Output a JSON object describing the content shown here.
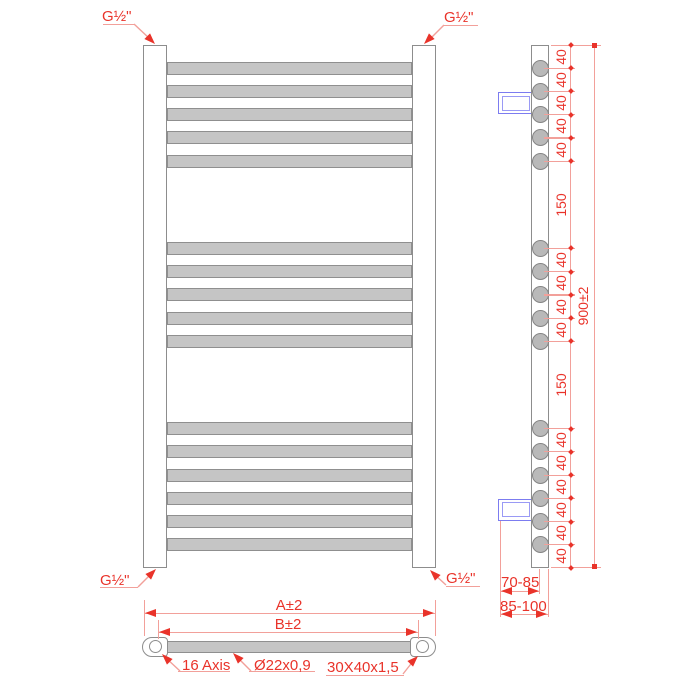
{
  "connection_labels": {
    "top_left": "G½\"",
    "top_right": "G½\"",
    "bottom_left": "G½\"",
    "bottom_right": "G½\""
  },
  "side_view": {
    "overall_height_label": "900±2",
    "wall_bracket_depth_label": "70-85",
    "wall_overall_depth_label": "85-100",
    "tube_groups": [
      5,
      5,
      6
    ],
    "bracket_after_circle": [
      2,
      14
    ],
    "dim_chain": [
      {
        "mm": 40,
        "label": "40"
      },
      {
        "mm": 40,
        "label": "40"
      },
      {
        "mm": 40,
        "label": "40"
      },
      {
        "mm": 40,
        "label": "40"
      },
      {
        "mm": 40,
        "label": "40"
      },
      {
        "mm": 150,
        "label": "150"
      },
      {
        "mm": 40,
        "label": "40"
      },
      {
        "mm": 40,
        "label": "40"
      },
      {
        "mm": 40,
        "label": "40"
      },
      {
        "mm": 40,
        "label": "40"
      },
      {
        "mm": 150,
        "label": "150"
      },
      {
        "mm": 40,
        "label": "40"
      },
      {
        "mm": 40,
        "label": "40"
      },
      {
        "mm": 40,
        "label": "40"
      },
      {
        "mm": 40,
        "label": "40"
      },
      {
        "mm": 40,
        "label": "40"
      },
      {
        "mm": 40,
        "label": "40"
      }
    ],
    "total_mm": 900
  },
  "plan_view": {
    "overall_width_label": "A±2",
    "axis_width_label": "B±2",
    "callout_axis_count": "16 Axis",
    "callout_tube_size": "Ø22x0,9",
    "callout_profile_size": "30X40x1,5"
  },
  "colors": {
    "dimension_red": "#e9332a",
    "dimension_pink": "#f2a09a",
    "tube_fill": "#c5c5c5",
    "tube_stroke": "#8f8f8f",
    "rail_stroke": "#8d8d8d",
    "circle_fill": "#b9b9b9",
    "bracket_blue": "#7c7cf0"
  }
}
